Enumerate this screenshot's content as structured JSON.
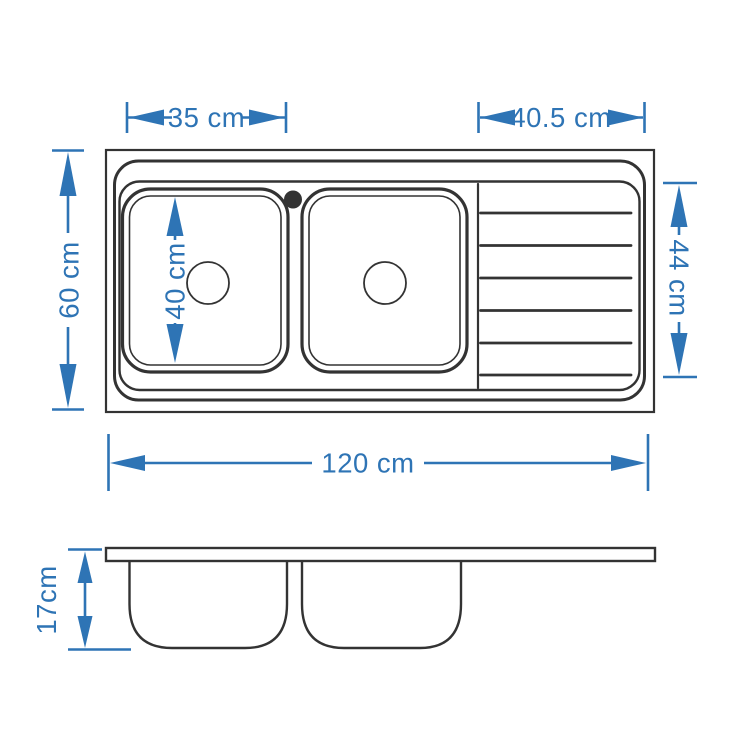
{
  "drawing": {
    "subject": "double-bowl kitchen sink with right drainboard",
    "views": [
      "top-view",
      "side-view"
    ]
  },
  "colors": {
    "line": "#333333",
    "dimension_blue": "#2E74B5",
    "background": "#FFFFFF"
  },
  "dimensions": {
    "bowl_width": {
      "label": "35 cm",
      "value": 35,
      "unit": "cm"
    },
    "drainboard_width": {
      "label": "40.5 cm",
      "value": 40.5,
      "unit": "cm"
    },
    "overall_depth": {
      "label": "60 cm",
      "value": 60,
      "unit": "cm"
    },
    "bowl_inner_depth": {
      "label": "40 cm",
      "value": 40,
      "unit": "cm"
    },
    "drainboard_depth": {
      "label": "44 cm",
      "value": 44,
      "unit": "cm"
    },
    "overall_width": {
      "label": "120 cm",
      "value": 120,
      "unit": "cm"
    },
    "bowl_height": {
      "label": "17cm",
      "value": 17,
      "unit": "cm"
    }
  }
}
